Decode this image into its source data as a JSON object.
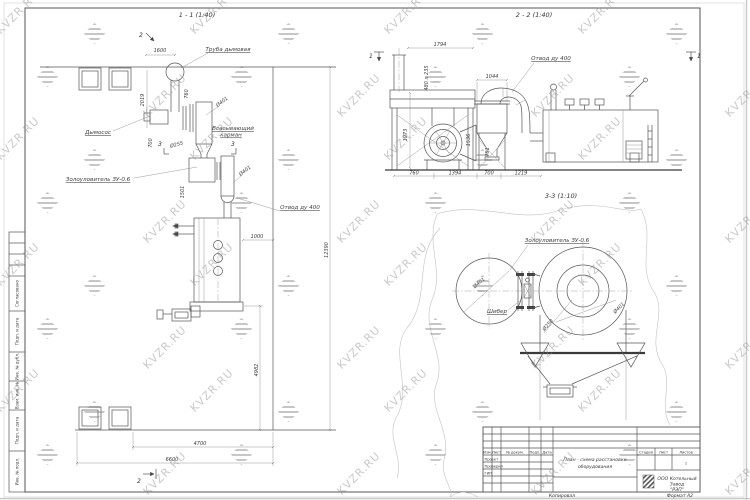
{
  "watermark": {
    "text": "KVZR.RU"
  },
  "plan": {
    "title": "1 - 1 (1:40)",
    "labels": {
      "chimney": "Труба дымовая",
      "fan": "Дымосос",
      "pocket_line1": "Всасывающий",
      "pocket_line2": "карман",
      "ash_catcher": "Золоуловитель ЗУ-0.6",
      "outlet": "Отвод ду 400"
    },
    "dims": {
      "d1600": "1600",
      "d2019": "2019",
      "d760": "760",
      "d401_top": "Ø401",
      "d255": "Ø255",
      "d700": "700",
      "d1501": "1501",
      "d401_mid": "Ø401",
      "d1000": "1000",
      "d12390": "12390",
      "d4982": "4982",
      "d4700": "4700",
      "d6600": "6600"
    },
    "markers": {
      "sec2": "2",
      "sec3": "3"
    }
  },
  "section22": {
    "title": "2 - 2 (1:40)",
    "labels": {
      "outlet": "Отвод ду 400"
    },
    "dims": {
      "d1794": "1794",
      "d480x235": "480 x 235",
      "d1044": "1044",
      "d1973": "1973",
      "d1536": "1536",
      "d751": "751",
      "d760": "760",
      "d1394": "1394",
      "d700": "700",
      "d1219": "1219"
    },
    "markers": {
      "sec1": "1"
    }
  },
  "section33": {
    "title": "3-3 (1:10)",
    "labels": {
      "ash_catcher": "Золоуловитель ЗУ-0.6",
      "gate": "Шибер"
    },
    "dims": {
      "d401_left": "Ø401",
      "d250": "Ø250",
      "d401_right": "Ø401"
    }
  },
  "titleblock": {
    "header_cols": {
      "izm": "Изм.",
      "list": "Лист",
      "doc": "№ докум.",
      "podp": "Подп.",
      "data": "Дата"
    },
    "rows": {
      "r1": "Проект",
      "r2": "Проверил",
      "r3": "ГИП"
    },
    "doc_title_line1": "План - схема расстановки",
    "doc_title_line2": "оборудования",
    "stage_col": "Стадия",
    "sheet_col": "Лист",
    "sheets_col": "Листов",
    "sheets_value": "1",
    "company_line1": "ООО Котельный",
    "company_line2": "Завод",
    "company_line3": "\"РЭП\"",
    "copied": "Копировал",
    "format": "Формат А2"
  },
  "sidestrip": {
    "agreed": "Согласовано",
    "items": [
      "Подп. и дата",
      "Инв. № дубл.",
      "Взам. инв. №",
      "Подп. и дата",
      "Инв. № подл."
    ]
  }
}
